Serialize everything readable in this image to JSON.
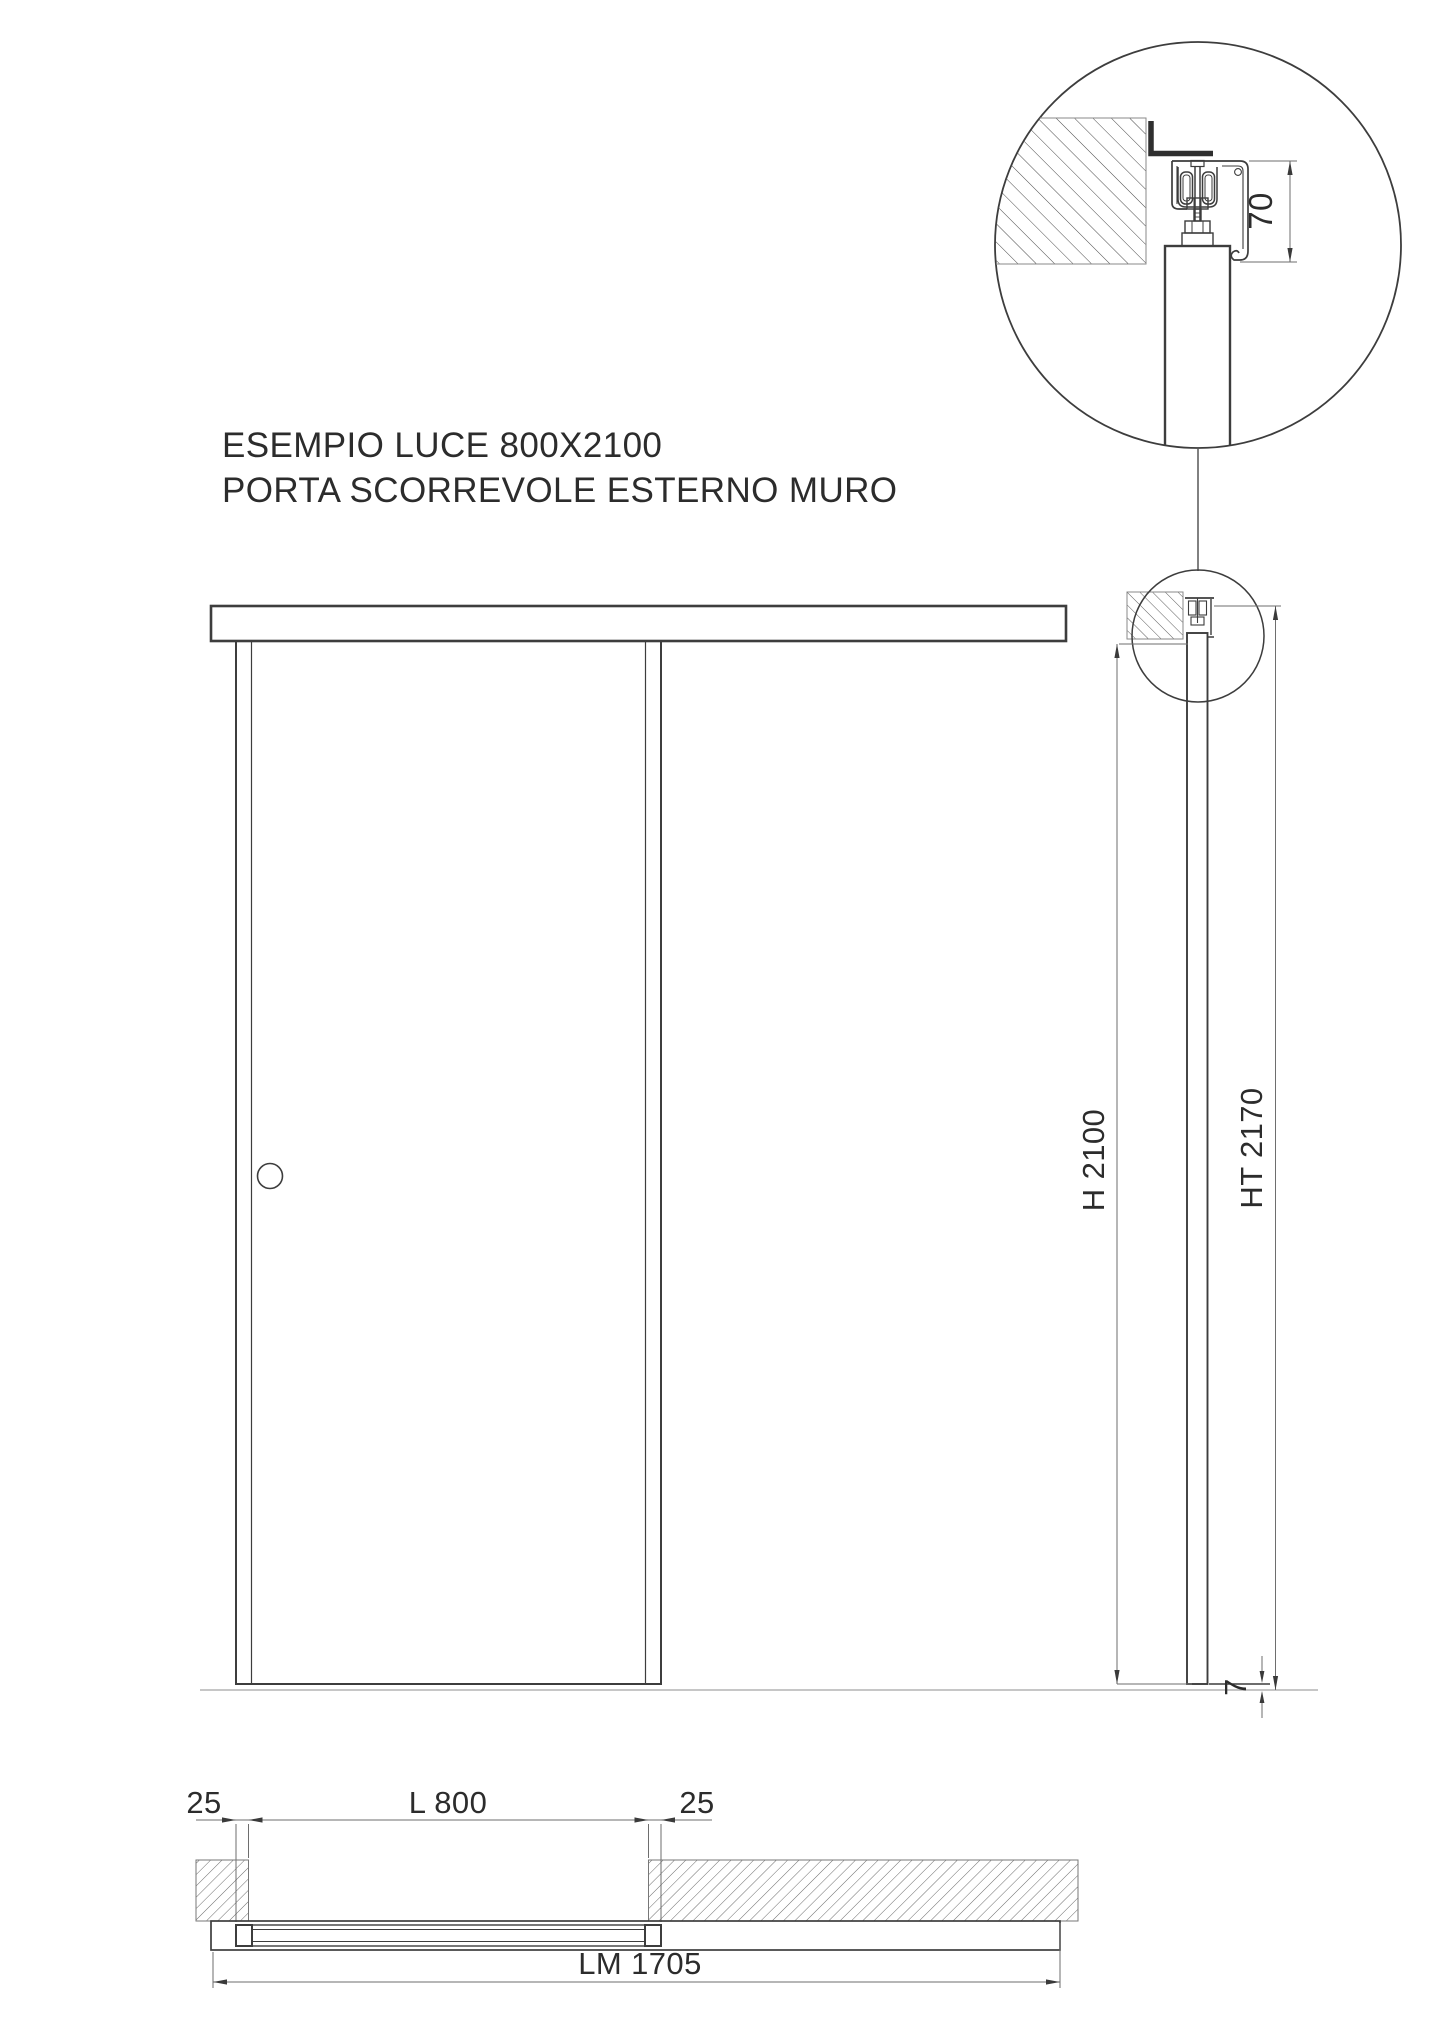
{
  "title": {
    "line1": "ESEMPIO LUCE 800X2100",
    "line2": "PORTA SCORREVOLE ESTERNO MURO"
  },
  "detail_view": {
    "dim_track_height": "70"
  },
  "section_view": {
    "dim_door_height": "H 2100",
    "dim_total_height": "HT 2170",
    "dim_floor_clearance": "7"
  },
  "plan_view": {
    "dim_overlap_left": "25",
    "dim_clear_width": "L 800",
    "dim_overlap_right": "25",
    "dim_rail_length": "LM 1705"
  },
  "colors": {
    "drawing_line": "#3d3d3d",
    "dimension_line": "#6e6e6e",
    "floor_line": "#b3b3b3",
    "text": "#2c2c2c",
    "background": "#ffffff"
  }
}
